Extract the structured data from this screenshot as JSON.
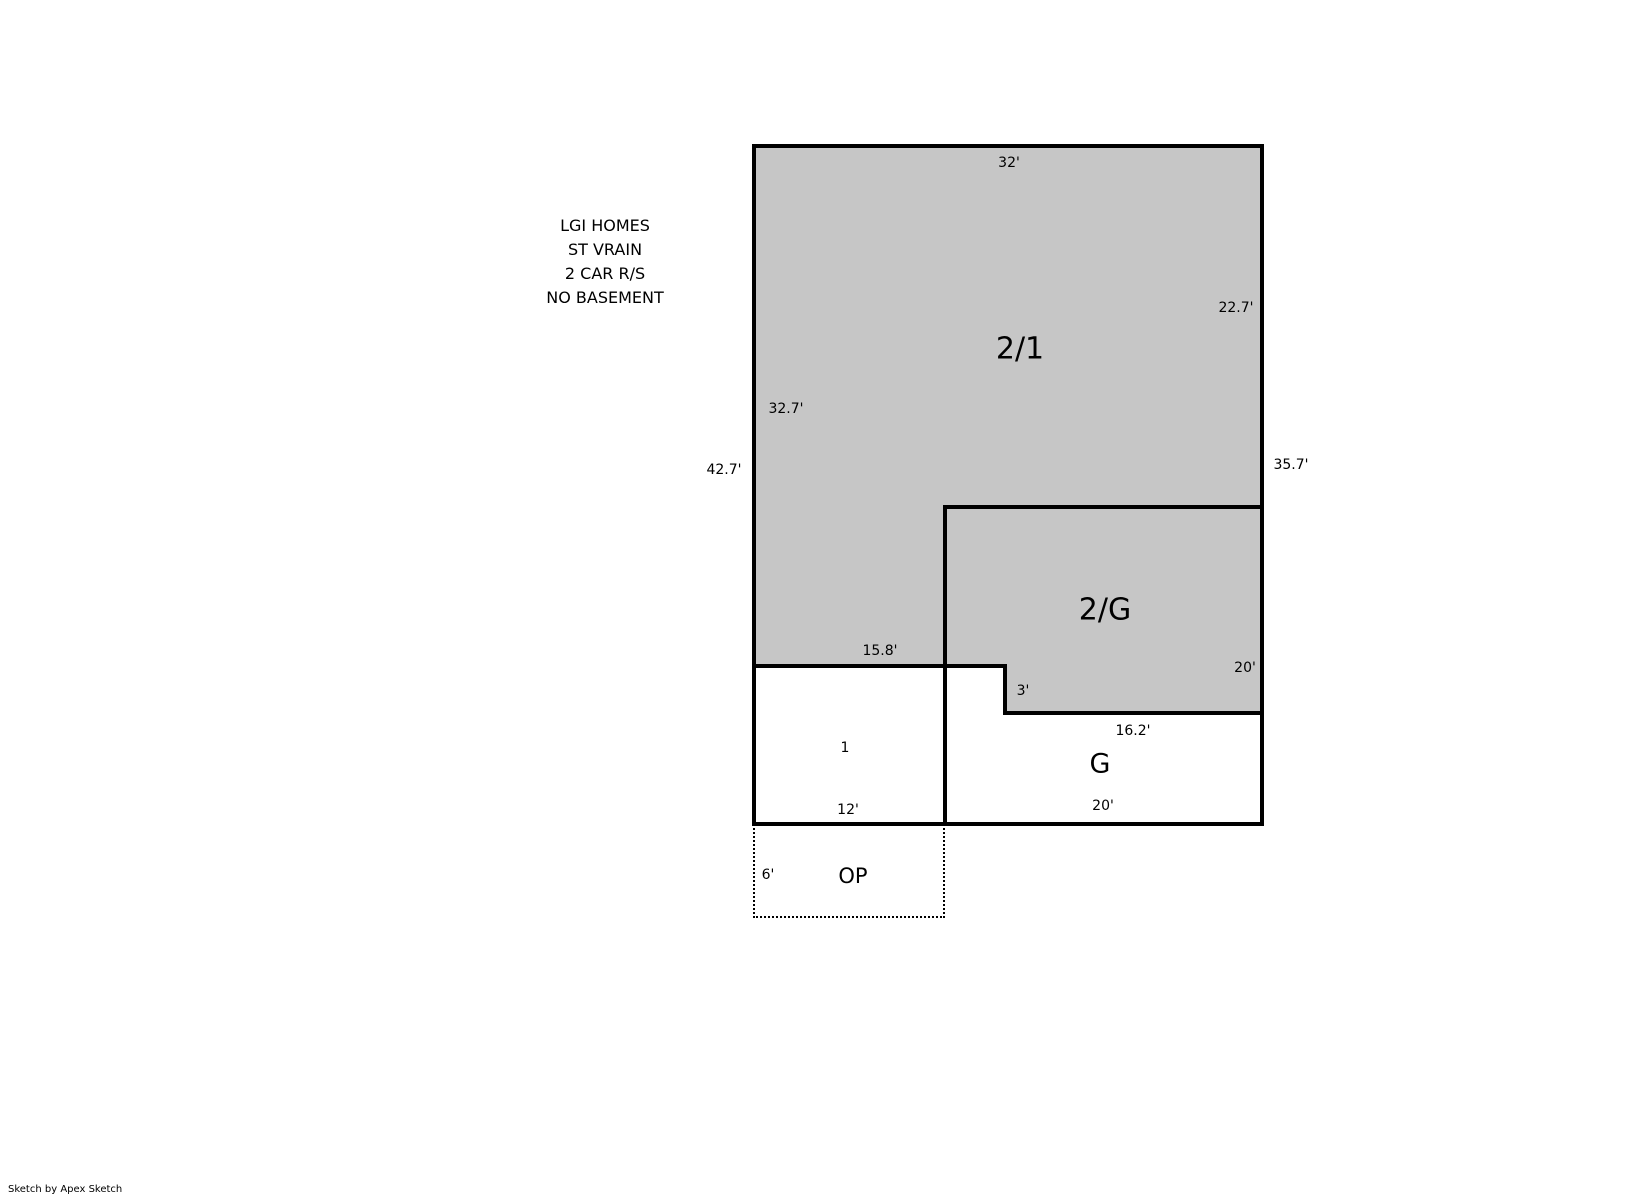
{
  "header": {
    "lines": [
      "LGI HOMES",
      "ST VRAIN",
      "2 CAR R/S",
      "NO BASEMENT"
    ]
  },
  "floorplan": {
    "areas": {
      "upper": {
        "label": "2/1"
      },
      "upper_over_garage": {
        "label": "2/G"
      },
      "first_floor": {
        "label": "1"
      },
      "garage": {
        "label": "G"
      },
      "open_porch": {
        "label": "OP"
      }
    },
    "dimensions": {
      "top_width": "32'",
      "right_upper": "22.7'",
      "right_total": "35.7'",
      "left_upper": "32.7'",
      "left_total": "42.7'",
      "interior_left": "15.8'",
      "notch": "3'",
      "garage_top": "16.2'",
      "garage_right": "20'",
      "garage_bottom": "20'",
      "first_floor_bottom": "12'",
      "porch_left": "6'"
    },
    "colors": {
      "area_fill": "#c6c6c6",
      "wall": "#000000"
    }
  },
  "footer": {
    "credit": "Sketch by Apex Sketch"
  }
}
